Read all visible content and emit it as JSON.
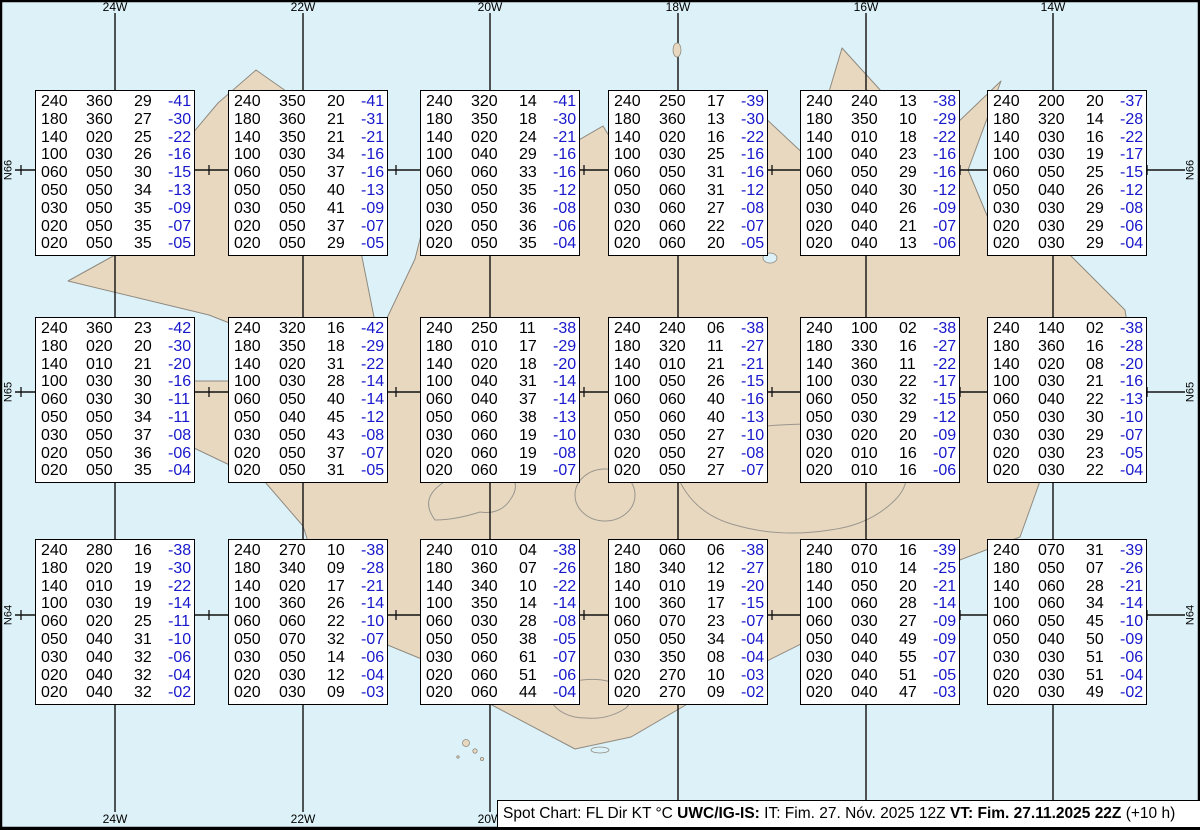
{
  "grid": {
    "meridians": [
      "24W",
      "22W",
      "20W",
      "18W",
      "16W",
      "14W"
    ],
    "parallels": [
      "N66",
      "N65",
      "N64"
    ]
  },
  "footer": {
    "segments": [
      {
        "text": "Spot Chart: FL Dir KT °C ",
        "bold": false
      },
      {
        "text": "UWC/IG-IS:",
        "bold": true
      },
      {
        "text": " IT: Fim. 27. Nóv. 2025 12Z ",
        "bold": false
      },
      {
        "text": "VT: Fim. 27.11.2025 22Z",
        "bold": true
      },
      {
        "text": " (+10 h)",
        "bold": false
      }
    ]
  },
  "colors": {
    "water": "#ddf2f8",
    "land": "#e8d8c0",
    "coast": "#8f8a80",
    "grid_line": "#111111",
    "temp_text": "#1717cc",
    "box_bg": "#ffffff"
  },
  "chart_data": {
    "type": "table",
    "title": "Spot Chart: FL Dir KT °C",
    "columns": [
      "FL",
      "Dir",
      "KT",
      "°C"
    ],
    "region_grid": {
      "meridians": [
        "24W",
        "22W",
        "20W",
        "18W",
        "16W",
        "14W"
      ],
      "parallels": [
        "N66",
        "N65",
        "N64"
      ]
    },
    "stations": [
      {
        "row": 1,
        "col": 1,
        "levels": [
          [
            "240",
            "360",
            "29",
            "-41"
          ],
          [
            "180",
            "360",
            "27",
            "-30"
          ],
          [
            "140",
            "020",
            "25",
            "-22"
          ],
          [
            "100",
            "030",
            "26",
            "-16"
          ],
          [
            "060",
            "050",
            "30",
            "-15"
          ],
          [
            "050",
            "050",
            "34",
            "-13"
          ],
          [
            "030",
            "050",
            "35",
            "-09"
          ],
          [
            "020",
            "050",
            "35",
            "-07"
          ],
          [
            "020",
            "050",
            "35",
            "-05"
          ]
        ]
      },
      {
        "row": 1,
        "col": 2,
        "levels": [
          [
            "240",
            "350",
            "20",
            "-41"
          ],
          [
            "180",
            "360",
            "21",
            "-31"
          ],
          [
            "140",
            "350",
            "21",
            "-21"
          ],
          [
            "100",
            "030",
            "34",
            "-16"
          ],
          [
            "060",
            "050",
            "37",
            "-16"
          ],
          [
            "050",
            "050",
            "40",
            "-13"
          ],
          [
            "030",
            "050",
            "41",
            "-09"
          ],
          [
            "020",
            "050",
            "37",
            "-07"
          ],
          [
            "020",
            "050",
            "29",
            "-05"
          ]
        ]
      },
      {
        "row": 1,
        "col": 3,
        "levels": [
          [
            "240",
            "320",
            "14",
            "-41"
          ],
          [
            "180",
            "350",
            "18",
            "-30"
          ],
          [
            "140",
            "020",
            "24",
            "-21"
          ],
          [
            "100",
            "040",
            "29",
            "-16"
          ],
          [
            "060",
            "060",
            "33",
            "-16"
          ],
          [
            "050",
            "050",
            "35",
            "-12"
          ],
          [
            "030",
            "050",
            "36",
            "-08"
          ],
          [
            "020",
            "050",
            "36",
            "-06"
          ],
          [
            "020",
            "050",
            "35",
            "-04"
          ]
        ]
      },
      {
        "row": 1,
        "col": 4,
        "levels": [
          [
            "240",
            "250",
            "17",
            "-39"
          ],
          [
            "180",
            "360",
            "13",
            "-30"
          ],
          [
            "140",
            "020",
            "16",
            "-22"
          ],
          [
            "100",
            "030",
            "25",
            "-16"
          ],
          [
            "060",
            "050",
            "31",
            "-16"
          ],
          [
            "050",
            "060",
            "31",
            "-12"
          ],
          [
            "030",
            "060",
            "27",
            "-08"
          ],
          [
            "020",
            "060",
            "22",
            "-07"
          ],
          [
            "020",
            "060",
            "20",
            "-05"
          ]
        ]
      },
      {
        "row": 1,
        "col": 5,
        "levels": [
          [
            "240",
            "240",
            "13",
            "-38"
          ],
          [
            "180",
            "350",
            "10",
            "-29"
          ],
          [
            "140",
            "010",
            "18",
            "-22"
          ],
          [
            "100",
            "040",
            "23",
            "-16"
          ],
          [
            "060",
            "050",
            "29",
            "-16"
          ],
          [
            "050",
            "040",
            "30",
            "-12"
          ],
          [
            "030",
            "040",
            "26",
            "-09"
          ],
          [
            "020",
            "040",
            "21",
            "-07"
          ],
          [
            "020",
            "040",
            "13",
            "-06"
          ]
        ]
      },
      {
        "row": 1,
        "col": 6,
        "levels": [
          [
            "240",
            "200",
            "20",
            "-37"
          ],
          [
            "180",
            "320",
            "14",
            "-28"
          ],
          [
            "140",
            "030",
            "16",
            "-22"
          ],
          [
            "100",
            "030",
            "19",
            "-17"
          ],
          [
            "060",
            "050",
            "25",
            "-15"
          ],
          [
            "050",
            "040",
            "26",
            "-12"
          ],
          [
            "030",
            "030",
            "29",
            "-08"
          ],
          [
            "020",
            "030",
            "29",
            "-06"
          ],
          [
            "020",
            "030",
            "29",
            "-04"
          ]
        ]
      },
      {
        "row": 2,
        "col": 1,
        "levels": [
          [
            "240",
            "360",
            "23",
            "-42"
          ],
          [
            "180",
            "020",
            "20",
            "-30"
          ],
          [
            "140",
            "010",
            "21",
            "-20"
          ],
          [
            "100",
            "030",
            "30",
            "-16"
          ],
          [
            "060",
            "030",
            "30",
            "-11"
          ],
          [
            "050",
            "050",
            "34",
            "-11"
          ],
          [
            "030",
            "050",
            "37",
            "-08"
          ],
          [
            "020",
            "050",
            "36",
            "-06"
          ],
          [
            "020",
            "050",
            "35",
            "-04"
          ]
        ]
      },
      {
        "row": 2,
        "col": 2,
        "levels": [
          [
            "240",
            "320",
            "16",
            "-42"
          ],
          [
            "180",
            "350",
            "18",
            "-29"
          ],
          [
            "140",
            "020",
            "31",
            "-22"
          ],
          [
            "100",
            "030",
            "28",
            "-14"
          ],
          [
            "060",
            "050",
            "40",
            "-14"
          ],
          [
            "050",
            "040",
            "45",
            "-12"
          ],
          [
            "030",
            "050",
            "43",
            "-08"
          ],
          [
            "020",
            "050",
            "37",
            "-07"
          ],
          [
            "020",
            "050",
            "31",
            "-05"
          ]
        ]
      },
      {
        "row": 2,
        "col": 3,
        "levels": [
          [
            "240",
            "250",
            "11",
            "-38"
          ],
          [
            "180",
            "010",
            "17",
            "-29"
          ],
          [
            "140",
            "020",
            "18",
            "-20"
          ],
          [
            "100",
            "040",
            "31",
            "-14"
          ],
          [
            "060",
            "040",
            "37",
            "-14"
          ],
          [
            "050",
            "060",
            "38",
            "-13"
          ],
          [
            "030",
            "060",
            "19",
            "-10"
          ],
          [
            "020",
            "060",
            "19",
            "-08"
          ],
          [
            "020",
            "060",
            "19",
            "-07"
          ]
        ]
      },
      {
        "row": 2,
        "col": 4,
        "levels": [
          [
            "240",
            "240",
            "06",
            "-38"
          ],
          [
            "180",
            "320",
            "11",
            "-27"
          ],
          [
            "140",
            "010",
            "21",
            "-21"
          ],
          [
            "100",
            "050",
            "26",
            "-15"
          ],
          [
            "060",
            "060",
            "40",
            "-16"
          ],
          [
            "050",
            "060",
            "40",
            "-13"
          ],
          [
            "030",
            "050",
            "27",
            "-10"
          ],
          [
            "020",
            "050",
            "27",
            "-08"
          ],
          [
            "020",
            "050",
            "27",
            "-07"
          ]
        ]
      },
      {
        "row": 2,
        "col": 5,
        "levels": [
          [
            "240",
            "100",
            "02",
            "-38"
          ],
          [
            "180",
            "330",
            "16",
            "-27"
          ],
          [
            "140",
            "360",
            "11",
            "-22"
          ],
          [
            "100",
            "030",
            "22",
            "-17"
          ],
          [
            "060",
            "050",
            "32",
            "-15"
          ],
          [
            "050",
            "030",
            "29",
            "-12"
          ],
          [
            "030",
            "020",
            "20",
            "-09"
          ],
          [
            "020",
            "010",
            "16",
            "-07"
          ],
          [
            "020",
            "010",
            "16",
            "-06"
          ]
        ]
      },
      {
        "row": 2,
        "col": 6,
        "levels": [
          [
            "240",
            "140",
            "02",
            "-38"
          ],
          [
            "180",
            "360",
            "16",
            "-28"
          ],
          [
            "140",
            "020",
            "08",
            "-20"
          ],
          [
            "100",
            "030",
            "21",
            "-16"
          ],
          [
            "060",
            "040",
            "22",
            "-13"
          ],
          [
            "050",
            "030",
            "30",
            "-10"
          ],
          [
            "030",
            "030",
            "29",
            "-07"
          ],
          [
            "020",
            "030",
            "23",
            "-05"
          ],
          [
            "020",
            "030",
            "22",
            "-04"
          ]
        ]
      },
      {
        "row": 3,
        "col": 1,
        "levels": [
          [
            "240",
            "280",
            "16",
            "-38"
          ],
          [
            "180",
            "020",
            "19",
            "-30"
          ],
          [
            "140",
            "010",
            "19",
            "-22"
          ],
          [
            "100",
            "030",
            "19",
            "-14"
          ],
          [
            "060",
            "020",
            "25",
            "-11"
          ],
          [
            "050",
            "040",
            "31",
            "-10"
          ],
          [
            "030",
            "040",
            "32",
            "-06"
          ],
          [
            "020",
            "040",
            "32",
            "-04"
          ],
          [
            "020",
            "040",
            "32",
            "-02"
          ]
        ]
      },
      {
        "row": 3,
        "col": 2,
        "levels": [
          [
            "240",
            "270",
            "10",
            "-38"
          ],
          [
            "180",
            "340",
            "09",
            "-28"
          ],
          [
            "140",
            "020",
            "17",
            "-21"
          ],
          [
            "100",
            "360",
            "26",
            "-14"
          ],
          [
            "060",
            "060",
            "22",
            "-10"
          ],
          [
            "050",
            "070",
            "32",
            "-07"
          ],
          [
            "030",
            "050",
            "14",
            "-06"
          ],
          [
            "020",
            "030",
            "12",
            "-04"
          ],
          [
            "020",
            "030",
            "09",
            "-03"
          ]
        ]
      },
      {
        "row": 3,
        "col": 3,
        "levels": [
          [
            "240",
            "010",
            "04",
            "-38"
          ],
          [
            "180",
            "360",
            "07",
            "-26"
          ],
          [
            "140",
            "340",
            "10",
            "-22"
          ],
          [
            "100",
            "350",
            "14",
            "-14"
          ],
          [
            "060",
            "030",
            "28",
            "-08"
          ],
          [
            "050",
            "050",
            "38",
            "-05"
          ],
          [
            "030",
            "060",
            "61",
            "-07"
          ],
          [
            "020",
            "060",
            "51",
            "-06"
          ],
          [
            "020",
            "060",
            "44",
            "-04"
          ]
        ]
      },
      {
        "row": 3,
        "col": 4,
        "levels": [
          [
            "240",
            "060",
            "06",
            "-38"
          ],
          [
            "180",
            "340",
            "12",
            "-27"
          ],
          [
            "140",
            "010",
            "19",
            "-20"
          ],
          [
            "100",
            "360",
            "17",
            "-15"
          ],
          [
            "060",
            "070",
            "23",
            "-07"
          ],
          [
            "050",
            "050",
            "34",
            "-04"
          ],
          [
            "030",
            "350",
            "08",
            "-04"
          ],
          [
            "020",
            "270",
            "10",
            "-03"
          ],
          [
            "020",
            "270",
            "09",
            "-02"
          ]
        ]
      },
      {
        "row": 3,
        "col": 5,
        "levels": [
          [
            "240",
            "070",
            "16",
            "-39"
          ],
          [
            "180",
            "010",
            "14",
            "-25"
          ],
          [
            "140",
            "050",
            "20",
            "-21"
          ],
          [
            "100",
            "060",
            "28",
            "-14"
          ],
          [
            "060",
            "030",
            "27",
            "-09"
          ],
          [
            "050",
            "040",
            "49",
            "-09"
          ],
          [
            "030",
            "040",
            "55",
            "-07"
          ],
          [
            "020",
            "040",
            "51",
            "-05"
          ],
          [
            "020",
            "040",
            "47",
            "-03"
          ]
        ]
      },
      {
        "row": 3,
        "col": 6,
        "levels": [
          [
            "240",
            "070",
            "31",
            "-39"
          ],
          [
            "180",
            "050",
            "07",
            "-26"
          ],
          [
            "140",
            "060",
            "28",
            "-21"
          ],
          [
            "100",
            "060",
            "34",
            "-14"
          ],
          [
            "060",
            "050",
            "45",
            "-10"
          ],
          [
            "050",
            "040",
            "50",
            "-09"
          ],
          [
            "030",
            "030",
            "51",
            "-06"
          ],
          [
            "020",
            "030",
            "51",
            "-04"
          ],
          [
            "020",
            "030",
            "49",
            "-02"
          ]
        ]
      }
    ]
  }
}
